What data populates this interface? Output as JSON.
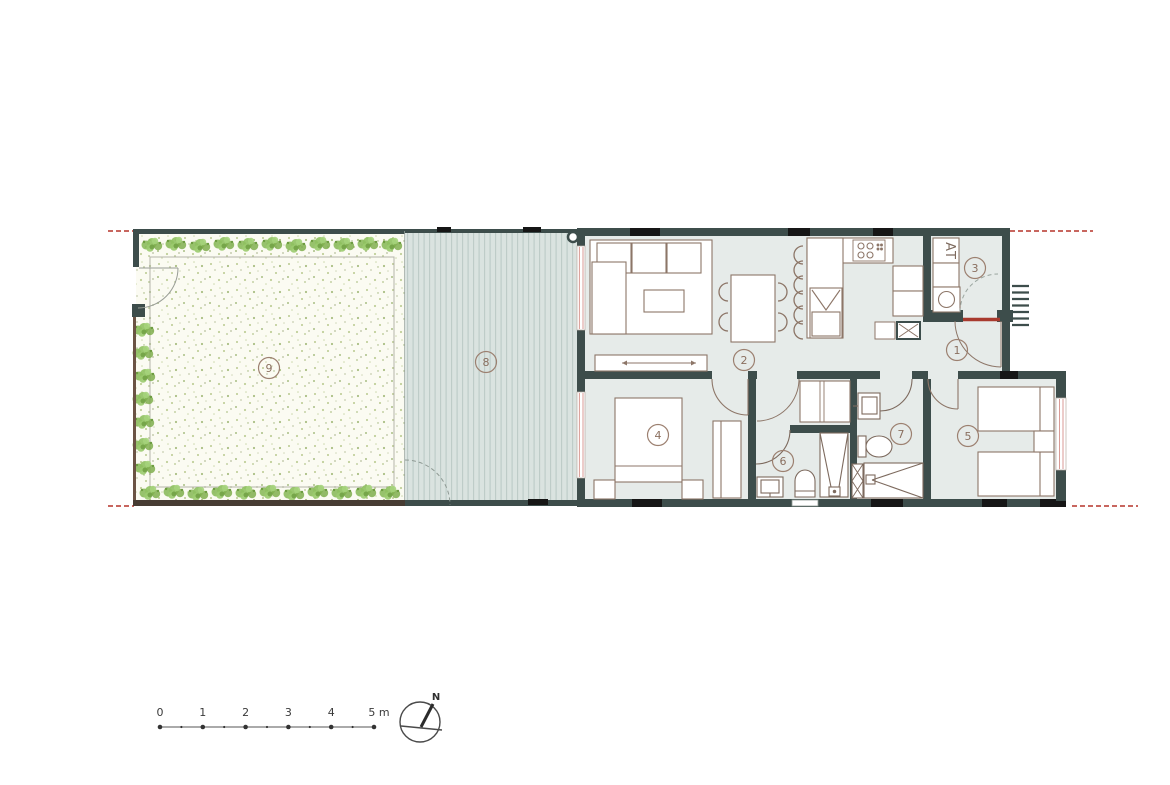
{
  "plan": {
    "rooms": [
      {
        "key": "entrance-hall",
        "number": "1"
      },
      {
        "key": "living-dining-kitchen",
        "number": "2"
      },
      {
        "key": "utility-room",
        "number": "3"
      },
      {
        "key": "bedroom-1",
        "number": "4"
      },
      {
        "key": "bedroom-2",
        "number": "5"
      },
      {
        "key": "bathroom-1",
        "number": "6"
      },
      {
        "key": "bathroom-2",
        "number": "7"
      },
      {
        "key": "deck-terrace",
        "number": "8"
      },
      {
        "key": "garden",
        "number": "9"
      }
    ],
    "utility_label": "AT",
    "compass_north": "N",
    "scale_ticks": [
      "0",
      "1",
      "2",
      "3",
      "4",
      "5 m"
    ]
  },
  "colors": {
    "wall": "#3d4d4b",
    "lintel": "#161616",
    "floor": "#e6ebe9",
    "deck_base": "#dae3e0",
    "deck_stripe": "#bccbc7",
    "garden_base": "#fbfbf2",
    "plant_green": "#85b755",
    "furniture_stroke": "#8d7668",
    "window_pink": "#d99a94",
    "threshold_red": "#a83a2e",
    "property_line_red": "#b5342a",
    "number_circle": "#9c8070"
  }
}
